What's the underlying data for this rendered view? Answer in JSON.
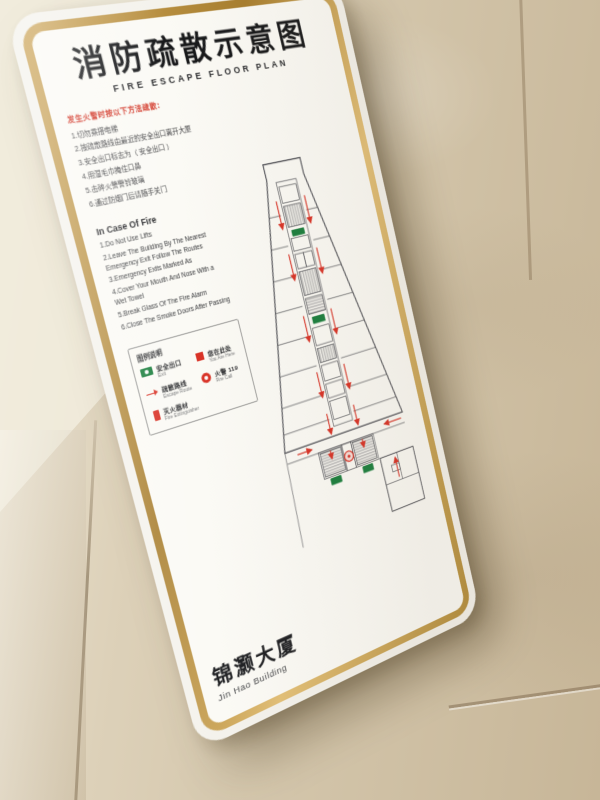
{
  "colors": {
    "frame_gold": "#b9903e",
    "sign_white": "#fbfaf5",
    "wall_beige": "#d2c4a9",
    "route_red": "#d93327",
    "exit_green": "#1b7f3e",
    "title_black": "#17181a"
  },
  "sign": {
    "title_cn": "消防疏散示意图",
    "title_en": "FIRE ESCAPE FLOOR PLAN",
    "cn_section": {
      "heading": "发生火警时按以下方法疏散：",
      "items": [
        "1.切勿乘搭电梯",
        "2.按疏散路线由最近的安全出口离开大厦",
        "3.安全出口标志为（ 安全出口 ）",
        "4.用湿毛巾掩住口鼻",
        "5.击碎火警警铃玻璃",
        "6.通过防烟门后请随手关门"
      ]
    },
    "en_section": {
      "heading": "In Case Of Fire",
      "items": [
        "1.Do Not Use Lifts",
        "2.Leave The Building By The Nearest Emergency Exit Follow The Routes",
        "3.Emergency Exits Marked As",
        "4.Cover Your Mouth And Nose With a Wet Towel",
        "5.Break Glass Of The Fire Alarm",
        "6.Close The Smoke Doors After Passing"
      ]
    },
    "legend": {
      "heading": "图例说明",
      "items": [
        {
          "icon": "exit-sign",
          "label": "安全出口",
          "sub": "Exit"
        },
        {
          "icon": "route-arrow",
          "label": "疏散路线",
          "sub": "Escape Route"
        },
        {
          "icon": "fire-extinguisher",
          "label": "灭火器材",
          "sub": "Fire Extinguisher"
        },
        {
          "icon": "you-are-here",
          "label": "您在此处",
          "sub": "You Are Here"
        },
        {
          "icon": "fire-call",
          "label": "火警 119",
          "sub": "Fire Call"
        }
      ]
    },
    "building_cn": "锦灏大厦",
    "building_en": "Jin Hao Building",
    "plan": {
      "type": "floor-plan",
      "route_color": "#d93327",
      "exit_color": "#1b7f3e",
      "features": [
        "escape-route-arrows",
        "elevator-core",
        "stair-cores",
        "exit-markers",
        "you-are-here-marker"
      ]
    }
  }
}
